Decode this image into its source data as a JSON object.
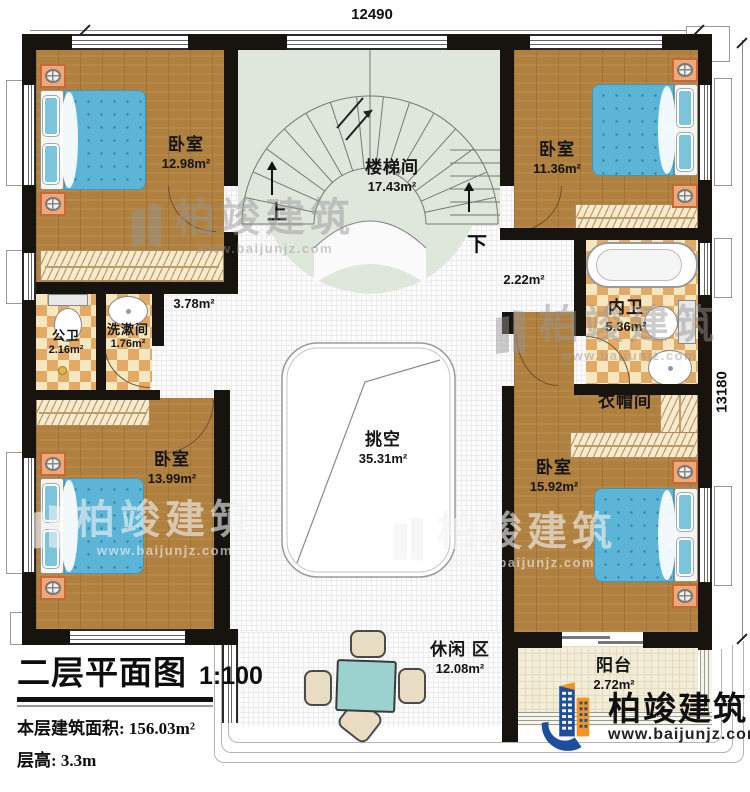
{
  "title_block": {
    "title": "二层平面图",
    "scale": "1:100",
    "area_label": "本层建筑面积:",
    "area_value": "156.03m²",
    "height_label": "层高:",
    "height_value": "3.3m"
  },
  "dimensions": {
    "top": "12490",
    "right": "13180"
  },
  "rooms": {
    "bedroom_tl": {
      "name": "卧室",
      "area": "12.98m²"
    },
    "stairwell": {
      "name": "楼梯间",
      "area": "17.43m²"
    },
    "bedroom_tr": {
      "name": "卧室",
      "area": "11.36m²"
    },
    "hall_left": {
      "area": "3.78m²"
    },
    "hall_right": {
      "area": "2.22m²"
    },
    "public_bath": {
      "name": "公卫",
      "area": "2.16m²"
    },
    "washroom": {
      "name": "洗漱间",
      "area": "1.76m²"
    },
    "inner_bath": {
      "name": "内卫",
      "area": "5.36m²"
    },
    "cloakroom": {
      "name": "衣帽间"
    },
    "bedroom_bl": {
      "name": "卧室",
      "area": "13.99m²"
    },
    "bedroom_br": {
      "name": "卧室",
      "area": "15.92m²"
    },
    "void": {
      "name": "挑空",
      "area": "35.31m²"
    },
    "leisure": {
      "name": "休闲 区",
      "area": "12.08m²"
    },
    "balcony": {
      "name": "阳台",
      "area": "2.72m²"
    }
  },
  "stairs": {
    "up": "上",
    "down": "下"
  },
  "watermark": {
    "brand": "柏竣建筑",
    "site": "www.baijunjz.com"
  },
  "logo": {
    "brand": "柏竣建筑",
    "site": "www.baijunjz.com"
  },
  "colors": {
    "wall": "#17130e",
    "wood": "#b0803f",
    "tile_light": "#f7e7c0",
    "tile_dark": "#e3aa66",
    "stair_floor": "#dfe6dc",
    "bed": "#5cb5d6",
    "balcony_floor": "#f3edd8",
    "logo_blue": "#1c4e9d",
    "logo_orange": "#f7941e"
  }
}
